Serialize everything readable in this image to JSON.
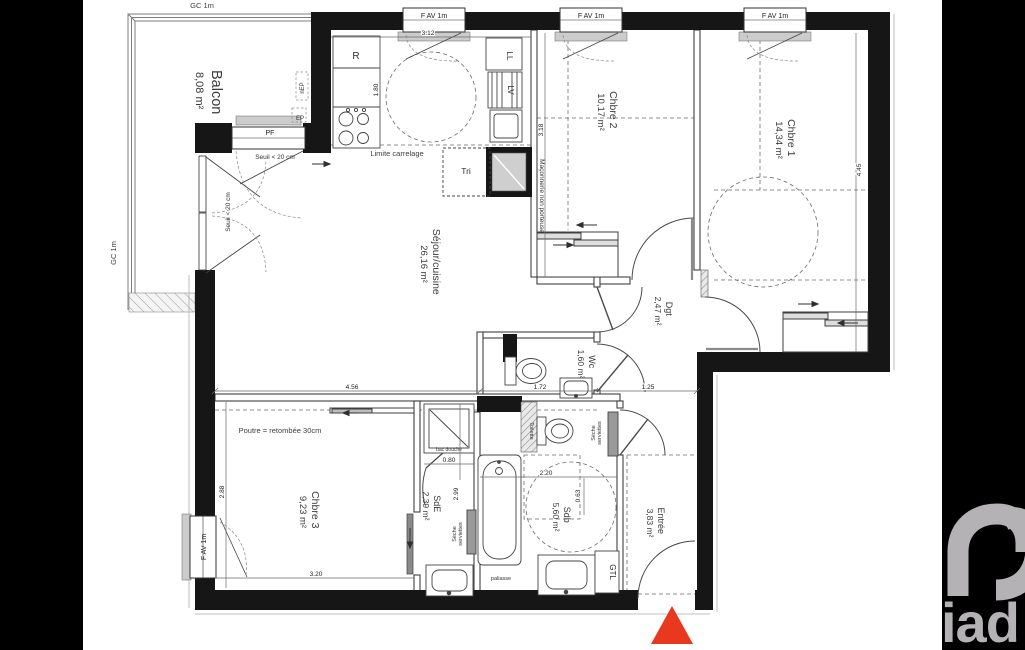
{
  "branding": {
    "logo_text": "iad"
  },
  "colors": {
    "wall": "#161616",
    "side_bar": "#000000",
    "entrance_marker_red": "#e8391f",
    "logo_gray": "#b5b2b5"
  },
  "rooms": {
    "balcon": {
      "name": "Balcon",
      "area": "8,08 m²"
    },
    "sejour": {
      "name": "Séjour/cuisine",
      "area": "26,16 m²"
    },
    "chbre2": {
      "name": "Chbre 2",
      "area": "10,17 m²"
    },
    "chbre1": {
      "name": "Chbre 1",
      "area": "14,34 m²"
    },
    "dgt": {
      "name": "Dgt",
      "area": "2,47 m²"
    },
    "wc": {
      "name": "Wc",
      "area": "1,60 m²"
    },
    "chbre3": {
      "name": "Chbre 3",
      "area": "9,23 m²"
    },
    "sde": {
      "name": "SdE",
      "area": "2,39 m²"
    },
    "sdb": {
      "name": "Sdb",
      "area": "5,60 m²"
    },
    "entree": {
      "name": "Entrée",
      "area": "3,83 m²"
    }
  },
  "labels": {
    "gc_top": "GC 1m",
    "gc_left": "GC 1m",
    "window": "F AV 1m",
    "pf": "PF",
    "seuil": "Seuil < 20 cm",
    "limite_carrelage": "Limite carrelage",
    "poutre": "Poutre = retombée 30cm",
    "maconnerie": "Maçonnerie non porteuse",
    "fridge": "R",
    "washing_machine": "LL",
    "dishwasher": "LV",
    "tri": "Tri",
    "bac_douche": "bac douche",
    "seche_line1": "Sèche",
    "seche_line2": "serviettes",
    "toilette": "Toilette",
    "paliasse": "paliasse",
    "gtl": "GTL",
    "nep": "nEP",
    "ep": "EP"
  },
  "dims": {
    "d312": "3.12",
    "d180": "1.80",
    "d318": "3.18",
    "d445": "4.45",
    "d456": "4.56",
    "d172": "1.72",
    "d125": "1.25",
    "d288": "2.88",
    "d320": "3.20",
    "d220": "2.20",
    "d080": "0.80",
    "d299": "2.99",
    "d063": "0.63"
  }
}
